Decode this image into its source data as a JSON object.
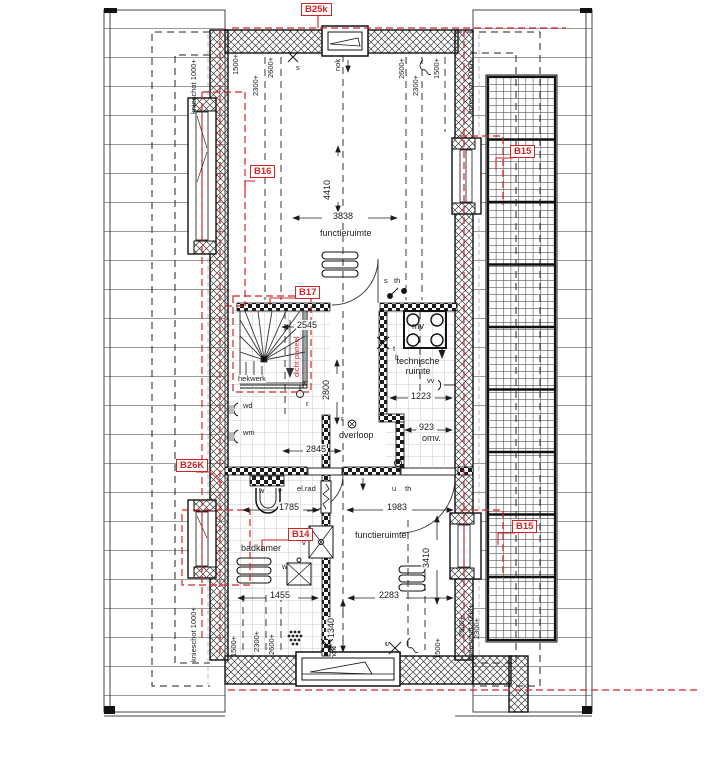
{
  "panel_labels": {
    "b25k": "B25k",
    "b16": "B16",
    "b17": "B17",
    "b26k": "B26K",
    "b14": "B14",
    "b15_upper": "B15",
    "b15_lower": "B15"
  },
  "room_labels": {
    "functieruimte_top": "functieruimte",
    "functieruimte_bottom": "functieruimte",
    "overloop": "overloop",
    "badkamer": "badkamer",
    "technische_ruimte": "technische ruimte"
  },
  "dimensions": {
    "w_top_inner": "3838",
    "h_top": "4410",
    "stair": "2545",
    "h_overloop": "2800",
    "w_overloop": "2845",
    "w_tech": "1223",
    "w_omv": "923",
    "omv_suffix": "omv.",
    "w_badkamer_top": "1785",
    "w_funct_top": "1983",
    "w_badkamer_bottom": "1455",
    "w_funct_bottom": "2283",
    "h_funct_bottom": "3410",
    "h_shower": "1340"
  },
  "height_markers": {
    "h1500": "1500+",
    "h2300": "2300+",
    "h2600": "2600+",
    "nok": "nok",
    "knieschot": "knieschot 1000+"
  },
  "annotations": {
    "hekwerk": "hekwerk",
    "dicht_paneel": "dicht paneel",
    "wd": "wd",
    "wm": "wm",
    "el_rad": "el.rad",
    "mv": "mv",
    "vv": "vv",
    "s": "s",
    "th": "th",
    "u": "u",
    "t": "t",
    "lt": "lt",
    "w": "w",
    "v": "v",
    "x": "x",
    "r": "r",
    "e": "e"
  },
  "colors": {
    "panel_red": "#d22424",
    "line_black": "#1c1c1c",
    "roof_grey": "#999999",
    "tile_grey": "#e0e0e0"
  }
}
